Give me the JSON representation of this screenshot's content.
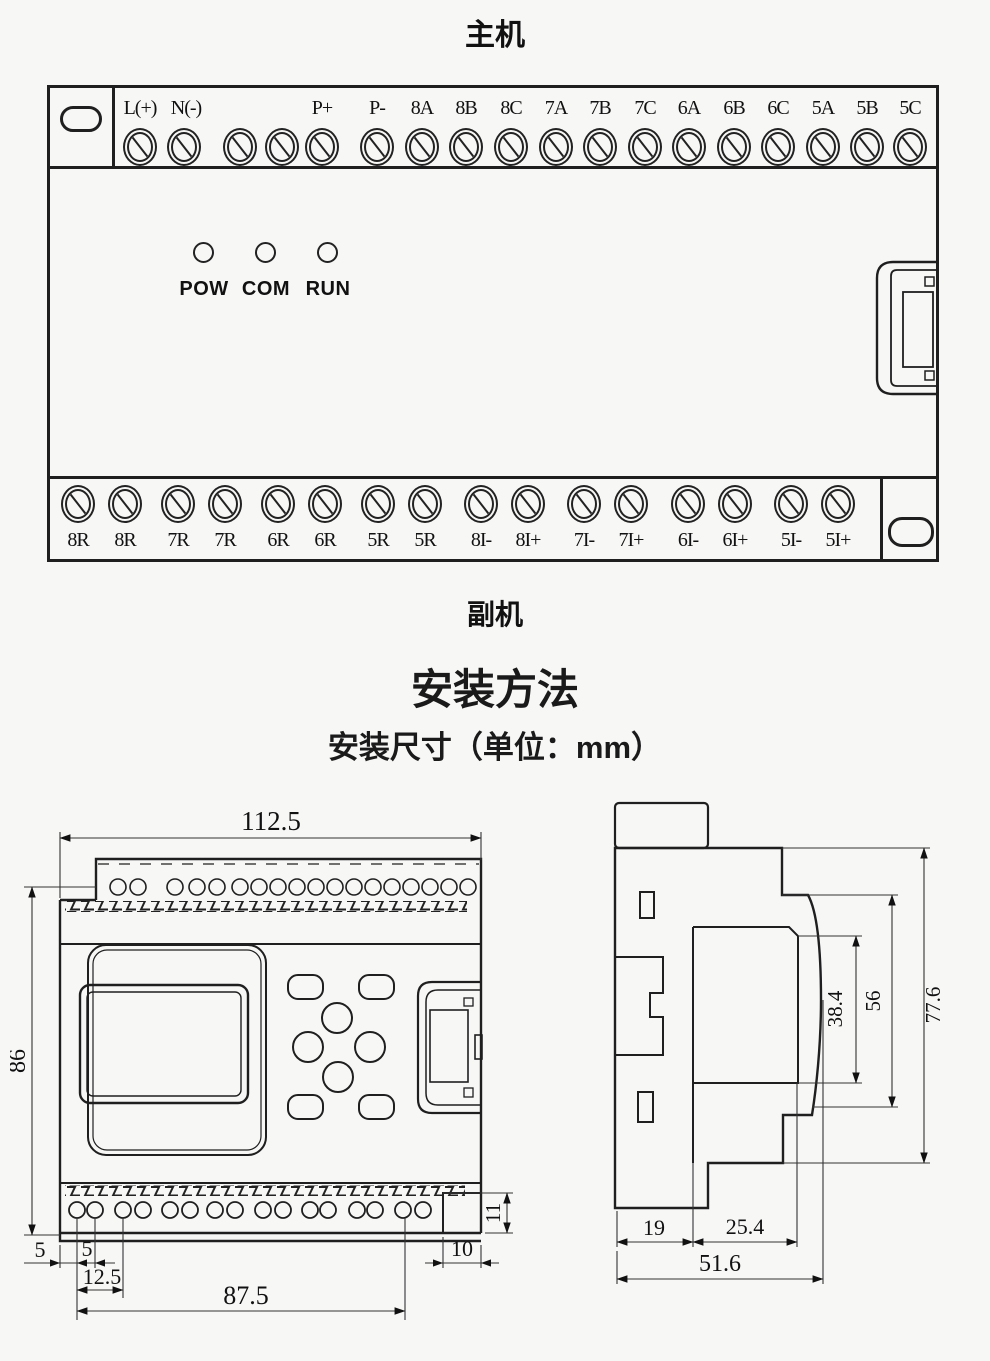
{
  "colors": {
    "line": "#1f1f1f",
    "background": "#f7f7f6"
  },
  "main_unit": {
    "title": "主机",
    "top_terminals": [
      "L(+)",
      "N(-)",
      "",
      "",
      "P+",
      "P-",
      "8A",
      "8B",
      "8C",
      "7A",
      "7B",
      "7C",
      "6A",
      "6B",
      "6C",
      "5A",
      "5B",
      "5C"
    ],
    "status_leds": [
      "POW",
      "COM",
      "RUN"
    ],
    "bottom_terminals": [
      "8R",
      "8R",
      "7R",
      "7R",
      "6R",
      "6R",
      "5R",
      "5R",
      "8I-",
      "8I+",
      "7I-",
      "7I+",
      "6I-",
      "6I+",
      "5I-",
      "5I+"
    ],
    "secondary_label": "副机"
  },
  "installation": {
    "heading": "安装方法",
    "subheading": "安装尺寸（单位：mm）"
  },
  "front_view": {
    "dimensions": {
      "overall_width": "112.5",
      "overall_height": "86",
      "edge_to_first_hole": "5",
      "hole_pitch": "5",
      "first_to_third_hole": "12.5",
      "hole_span": "87.5",
      "notch_height": "11",
      "notch_width": "10"
    }
  },
  "side_view": {
    "dimensions": {
      "cover_depth": "38.4",
      "body_depth": "56",
      "overall_depth": "77.6",
      "rail_section": "19",
      "front_section": "25.4",
      "overall_width": "51.6"
    }
  }
}
